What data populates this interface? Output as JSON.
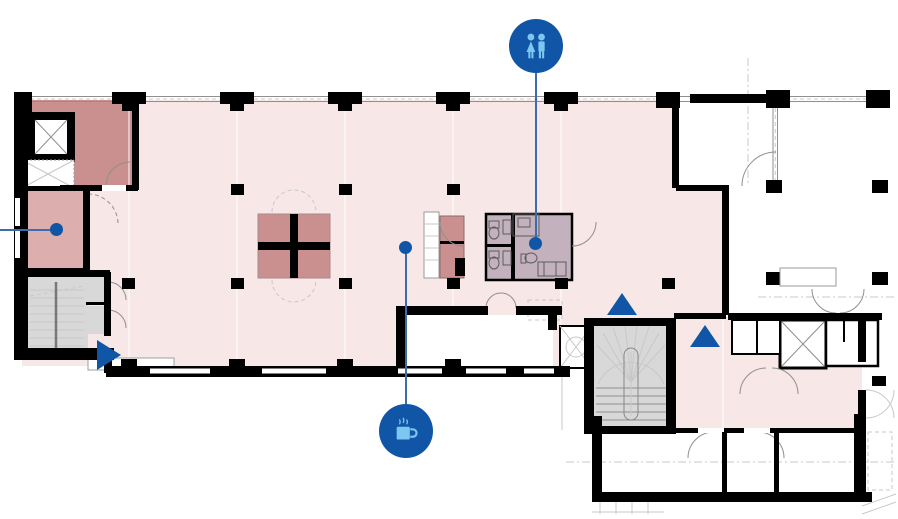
{
  "colors": {
    "wall": "#000000",
    "zone-open": "#f8e7e7",
    "zone-room-dark": "#c9908f",
    "zone-room-med": "#dcaeae",
    "zone-wet": "#c3b2bd",
    "zone-stair": "#d8d8d8",
    "line-gray": "#8f8f8f",
    "line-light": "#c8c8c8",
    "marker-blue": "#1156a6",
    "marker-glyph": "#7cc6ef",
    "leader-blue": "#3b6cb0"
  },
  "markers": {
    "restroom": {
      "icon": "restroom-icon",
      "circle": "left:509px;top:19px",
      "line": "left:535px;top:71px;height:168px",
      "dot": "left:529px;top:237px"
    },
    "coffee": {
      "icon": "coffee-icon",
      "circle": "left:379px;top:404px",
      "line": "left:405px;top:253px;height:152px",
      "dot": "left:399px;top:241px"
    },
    "left_room": {
      "dot": "left:50px;top:223px",
      "line": "left:0px;top:229px;width:51px"
    },
    "triangle_up_1": {
      "pos": "left:607px;top:293px"
    },
    "triangle_up_2": {
      "pos": "left:690px;top:325px"
    },
    "triangle_right": {
      "pos": "left:97px;top:340px"
    }
  }
}
